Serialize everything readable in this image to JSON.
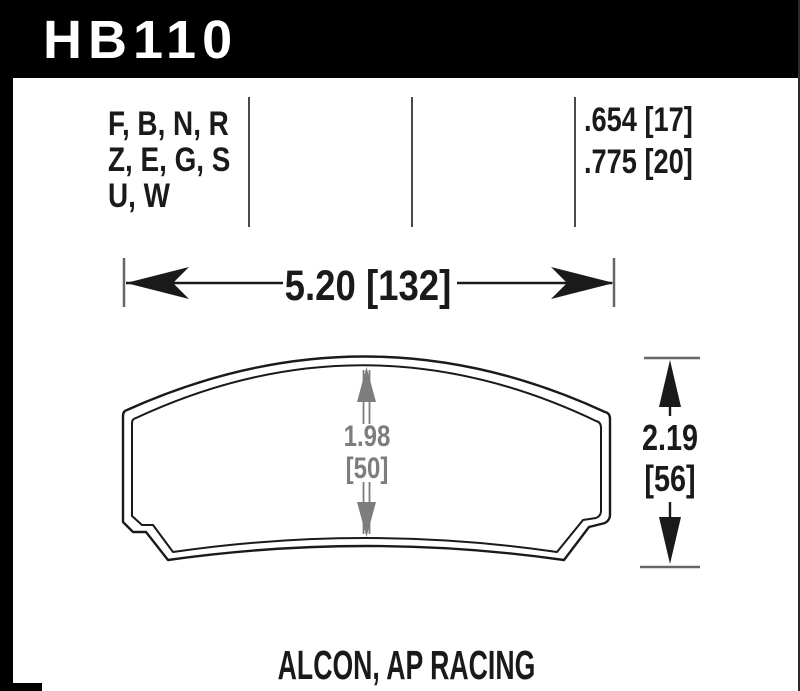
{
  "part_number": "HB110",
  "spec_table": {
    "compound_codes": [
      "F, B, N, R",
      "Z, E, G, S",
      "U, W"
    ],
    "pad_thickness": [
      ".654 [17]",
      ".775 [20]"
    ]
  },
  "dimensions": {
    "width": "5.20 [132]",
    "overall_height": "2.19",
    "overall_height_mm": "[56]",
    "center_height": "1.98",
    "center_height_mm": "[50]"
  },
  "applications": "ALCON, AP RACING",
  "colors": {
    "header_bg": "#000000",
    "header_text": "#ffffff",
    "drawing_line": "#1a1a1a",
    "dimension_gray": "#7d7d7d",
    "tick_gray": "#666666"
  }
}
